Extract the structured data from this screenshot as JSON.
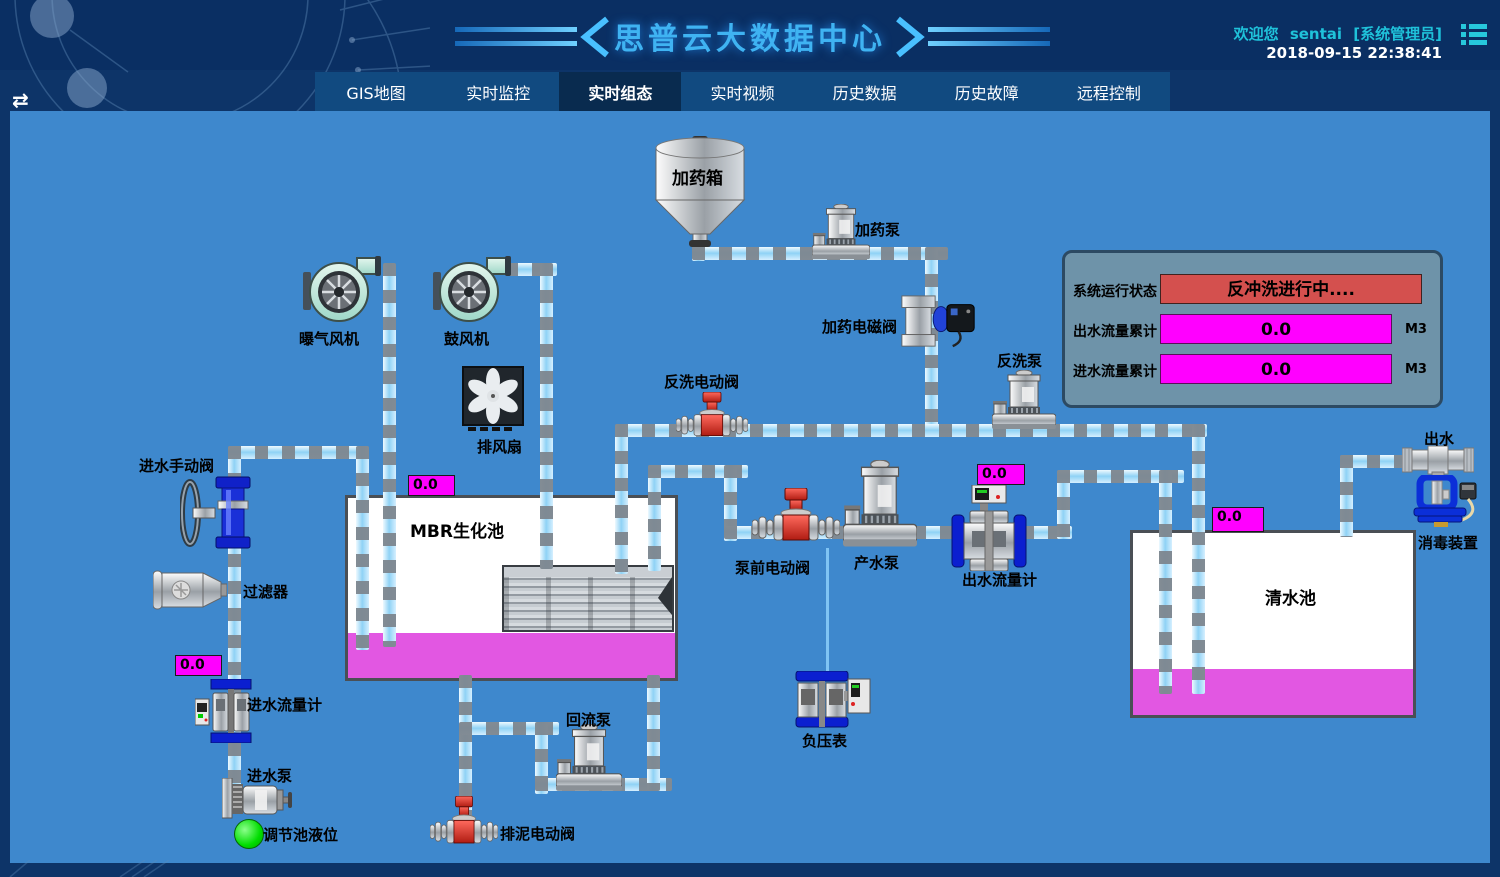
{
  "header": {
    "title": "思普云大数据中心",
    "welcome_prefix": "欢迎您",
    "username": "sentai",
    "role": "[系统管理员]",
    "datetime": "2018-09-15 22:38:41"
  },
  "nav": {
    "tabs": [
      {
        "label": "GIS地图",
        "active": false
      },
      {
        "label": "实时监控",
        "active": false
      },
      {
        "label": "实时组态",
        "active": true
      },
      {
        "label": "实时视频",
        "active": false
      },
      {
        "label": "历史数据",
        "active": false
      },
      {
        "label": "历史故障",
        "active": false
      },
      {
        "label": "远程控制",
        "active": false
      }
    ]
  },
  "status_panel": {
    "run_status_label": "系统运行状态",
    "run_status_value": "反冲洗进行中....",
    "outlet_total_label": "出水流量累计",
    "outlet_total_value": "0.0",
    "outlet_total_unit": "M3",
    "inlet_total_label": "进水流量累计",
    "inlet_total_value": "0.0",
    "inlet_total_unit": "M3"
  },
  "equipment": {
    "aeration_blower": "曝气风机",
    "blower": "鼓风机",
    "exhaust_fan": "排风扇",
    "dosing_tank": "加药箱",
    "dosing_pump": "加药泵",
    "dosing_solenoid_valve": "加药电磁阀",
    "backwash_valve": "反洗电动阀",
    "backwash_pump": "反洗泵",
    "inlet_manual_valve": "进水手动阀",
    "filter": "过滤器",
    "mbr_tank": "MBR生化池",
    "inlet_flow_meter": "进水流量计",
    "inlet_pump": "进水泵",
    "regulating_tank_level": "调节池液位",
    "prepump_valve": "泵前电动阀",
    "product_pump": "产水泵",
    "outlet_flow_meter": "出水流量计",
    "clean_water_tank": "清水池",
    "outlet": "出水",
    "disinfection_device": "消毒装置",
    "negative_pressure_gauge": "负压表",
    "return_pump": "回流泵",
    "sludge_valve": "排泥电动阀"
  },
  "values": {
    "mbr_tank_level": "0.0",
    "inlet_flow": "0.0",
    "outlet_flow": "0.0",
    "clean_water_level": "0.0"
  },
  "colors": {
    "accent_cyan": "#1fc2da",
    "title_blue": "#3fb3f2",
    "diagram_bg": "#3e88cd",
    "alarm_red": "#d4504e",
    "value_magenta": "#ff00ff",
    "liquid_magenta": "#e257e2",
    "ok_green": "#00dd00"
  }
}
